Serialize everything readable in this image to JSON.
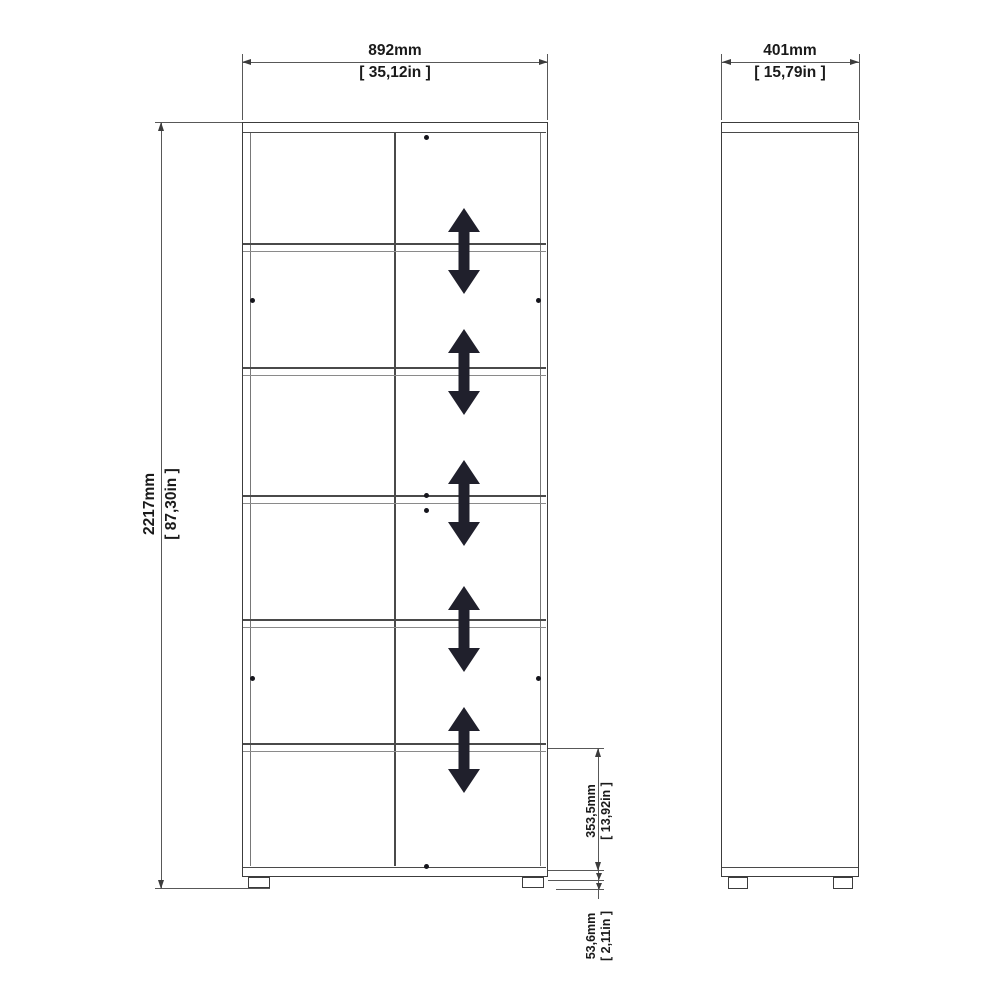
{
  "front": {
    "width": {
      "mm": "892mm",
      "in": "[ 35,12in ]"
    },
    "height": {
      "mm": "2217mm",
      "in": "[ 87,30in ]"
    },
    "shelf": {
      "mm": "353,5mm",
      "in": "[ 13,92in ]"
    },
    "base": {
      "mm": "53,6mm",
      "in": "[ 2,11in ]"
    }
  },
  "side": {
    "depth": {
      "mm": "401mm",
      "in": "[ 15,79in ]"
    }
  },
  "icons": {
    "adjustable_shelf": "double-headed-vertical-arrow-icon"
  },
  "colors": {
    "outline": "#3c3c3c",
    "light_line": "#8a8a8a",
    "arrow_fill": "#20202c",
    "text": "#1a1a1a",
    "background": "#ffffff"
  }
}
